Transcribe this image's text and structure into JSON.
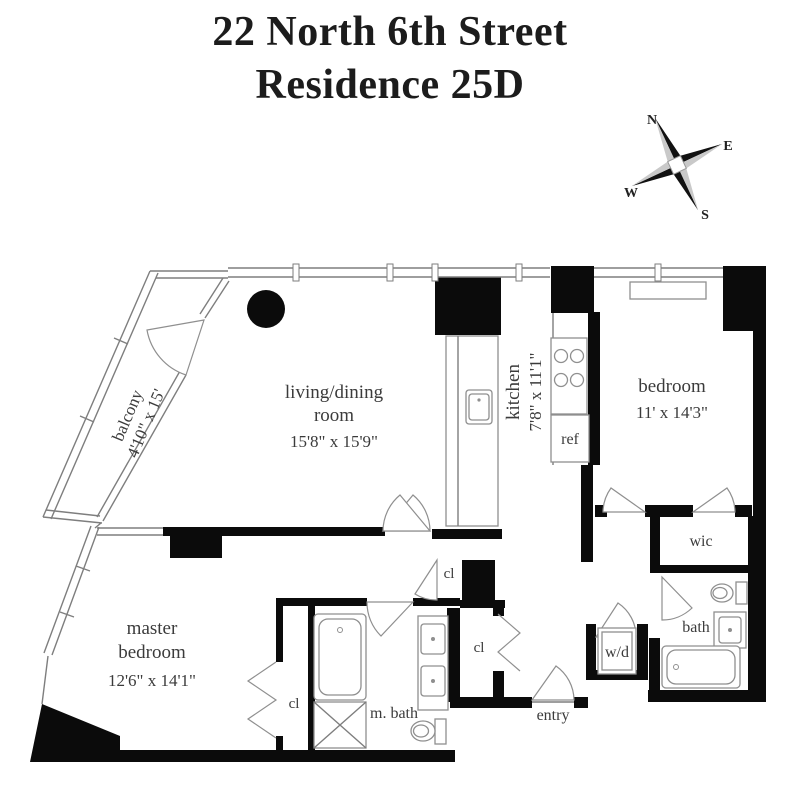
{
  "title": {
    "line1": "22 North 6th Street",
    "line2": "Residence 25D"
  },
  "compass": {
    "north": "N",
    "east": "E",
    "south": "S",
    "west": "W"
  },
  "rooms": {
    "balcony": {
      "name": "balcony",
      "dims": "4'10\" x 15'"
    },
    "living": {
      "name1": "living/dining",
      "name2": "room",
      "dims": "15'8\" x 15'9\""
    },
    "kitchen": {
      "name": "kitchen",
      "dims": "7'8\" x 11'1\""
    },
    "bedroom": {
      "name": "bedroom",
      "dims": "11' x 14'3\""
    },
    "master": {
      "name1": "master",
      "name2": "bedroom",
      "dims": "12'6\" x 14'1\""
    },
    "master_bath": {
      "name": "m. bath"
    },
    "bath": {
      "name": "bath"
    },
    "wic": {
      "name": "wic"
    },
    "entry": {
      "name": "entry"
    },
    "laundry": {
      "name": "w/d"
    },
    "fridge": {
      "name": "ref"
    }
  },
  "closets": [
    "cl",
    "cl",
    "cl"
  ],
  "colors": {
    "wall": "#0b0b0b",
    "thin_line": "#7e7e7e",
    "text": "#3b3b3b"
  }
}
